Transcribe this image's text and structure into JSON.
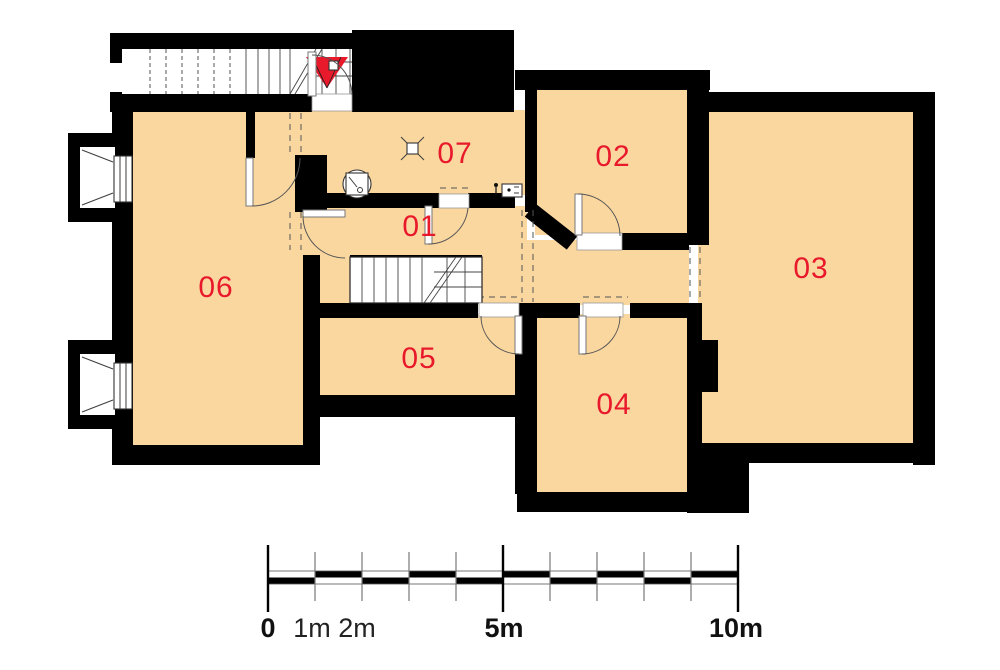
{
  "plan": {
    "type": "basement-floor-plan",
    "rooms": [
      {
        "id": "01",
        "label": "01"
      },
      {
        "id": "02",
        "label": "02"
      },
      {
        "id": "03",
        "label": "03"
      },
      {
        "id": "04",
        "label": "04"
      },
      {
        "id": "05",
        "label": "05"
      },
      {
        "id": "06",
        "label": "06"
      },
      {
        "id": "07",
        "label": "07"
      }
    ]
  },
  "scale_bar": {
    "unit": "m",
    "total_meters": 10,
    "labels": [
      {
        "text": "0",
        "bold": true
      },
      {
        "text": "1m",
        "bold": false
      },
      {
        "text": "2m",
        "bold": false
      },
      {
        "text": "5m",
        "bold": true
      },
      {
        "text": "10m",
        "bold": true
      }
    ]
  },
  "colors": {
    "wall": "#000000",
    "roomFill": "#FBD7A0",
    "labelRed": "#E8192B",
    "line": "#3C3C3C",
    "bg": "#FFFFFF"
  },
  "symbols": [
    "entrance-arrow-icon",
    "exterior-stairs-icon",
    "interior-stairs-icon",
    "boiler-icon",
    "floor-drain-icon",
    "electric-meter-icon",
    "window-well-icon",
    "door-swing-icon",
    "ceiling-opening-dashes"
  ]
}
